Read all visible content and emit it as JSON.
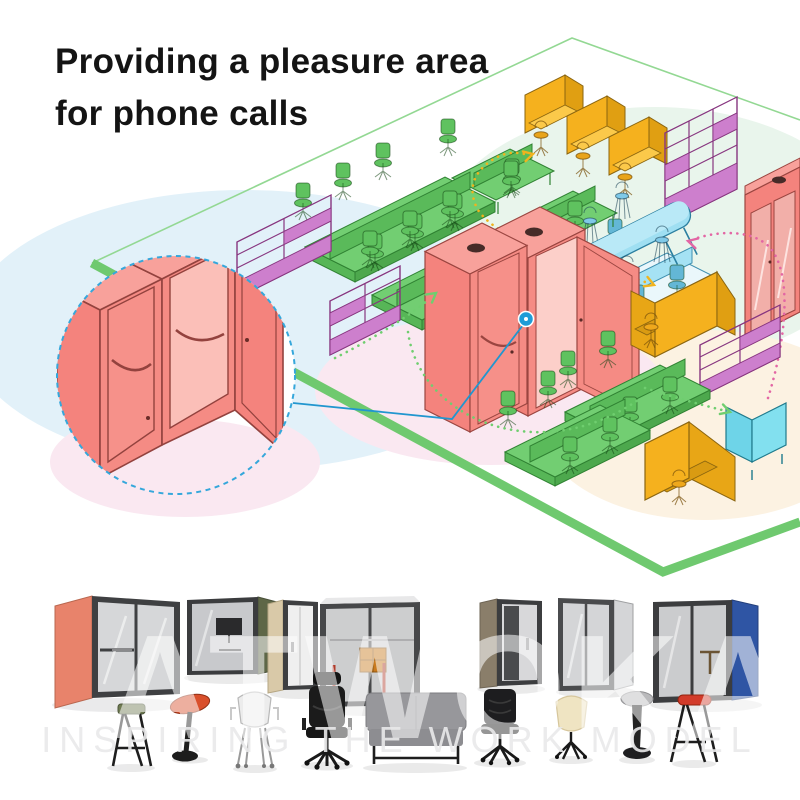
{
  "headline": {
    "line1": "Providing a pleasure area",
    "line2": "for phone calls",
    "text_color": "#141414"
  },
  "floor_plan": {
    "outline_color": "#6FC96F",
    "zones": [
      {
        "name": "workstations-zone",
        "blob_color": "#E2F1F9"
      },
      {
        "name": "focus-zone",
        "blob_color": "#E9F5EC"
      },
      {
        "name": "phone-booth-zone",
        "blob_color": "#FAE8F1"
      },
      {
        "name": "lounge-zone",
        "blob_color": "#FCF2E2"
      }
    ],
    "furniture": [
      {
        "name": "green-bench-desks",
        "color": "#72CE72",
        "count": 2
      },
      {
        "name": "green-desk-pairs",
        "color": "#72CE72",
        "count": 4
      },
      {
        "name": "yellow-privacy-desks",
        "color": "#F5B11E",
        "count": 3
      },
      {
        "name": "purple-shelving-units",
        "color": "#CD7FCD",
        "count": 4
      },
      {
        "name": "blue-bar-table",
        "color": "#9FDFF2",
        "count": 1
      },
      {
        "name": "blue-bar-stools",
        "color": "#7FC9E8",
        "count": 4
      },
      {
        "name": "red-phone-booths-center",
        "color": "#F4837D",
        "count": 2
      },
      {
        "name": "red-phone-booth-right",
        "color": "#F4837D",
        "count": 1
      },
      {
        "name": "yellow-booth-seats",
        "color": "#F5B11E",
        "count": 2
      },
      {
        "name": "blue-mini-booth",
        "color": "#82E0EF",
        "count": 1
      },
      {
        "name": "teal-desk-cluster",
        "color": "#A5E2F4",
        "count": 1
      }
    ],
    "arrows": [
      {
        "name": "flow-arrow-yellow-long",
        "color": "#F0B31E"
      },
      {
        "name": "flow-arrow-yellow-short",
        "color": "#F0B31E"
      },
      {
        "name": "flow-arrow-pink",
        "color": "#E366A4"
      },
      {
        "name": "flow-arrow-green",
        "color": "#6FCE6F"
      },
      {
        "name": "flow-arc-green",
        "color": "#6FCE6F"
      },
      {
        "name": "flow-arrow-green-right",
        "color": "#6FCE6F"
      }
    ],
    "callout": {
      "border_color": "#35A7DB",
      "subject": "red phone booths with open door"
    },
    "marker": {
      "color": "#1E9CD7"
    }
  },
  "products": {
    "booths": [
      {
        "name": "booth-salmon",
        "accent_color": "#E8836B"
      },
      {
        "name": "booth-dark-olive",
        "accent_color": "#5E6747"
      },
      {
        "name": "booth-beige",
        "accent_color": "#D9C9A8"
      },
      {
        "name": "booth-gray-meeting",
        "accent_color": "#C9CACC"
      },
      {
        "name": "booth-taupe",
        "accent_color": "#8A7E6A"
      },
      {
        "name": "booth-light-gray",
        "accent_color": "#D4D5D7"
      },
      {
        "name": "booth-blue",
        "accent_color": "#2F55A4"
      }
    ],
    "seating": [
      {
        "name": "high-stool-green-seat"
      },
      {
        "name": "leaning-stool-red"
      },
      {
        "name": "side-chair-white"
      },
      {
        "name": "executive-chair-black"
      },
      {
        "name": "sofa-gray"
      },
      {
        "name": "task-chair-black"
      },
      {
        "name": "shell-chair-cream"
      },
      {
        "name": "wobble-stool-gray"
      },
      {
        "name": "high-stool-red-seat"
      }
    ]
  },
  "watermark": {
    "brand": "ATWOKA",
    "tagline": "INSPIRING THE WORK MODEL"
  }
}
